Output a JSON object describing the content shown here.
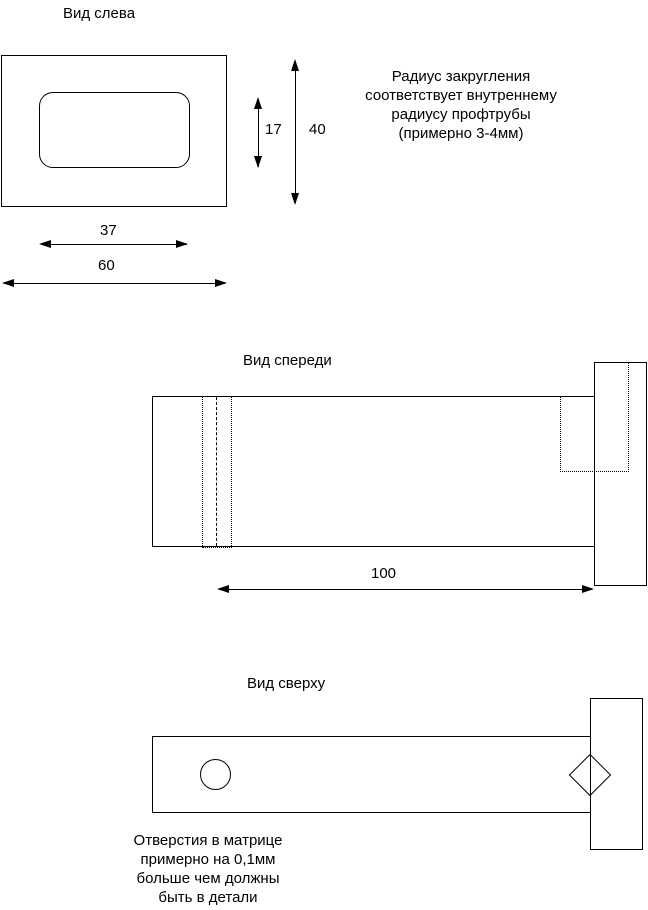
{
  "drawing": {
    "background": "#ffffff",
    "line_color": "#000000",
    "views": {
      "left": {
        "title": "Вид слева",
        "dims": {
          "hole_height": "17",
          "height": "40",
          "hole_width": "37",
          "width": "60"
        }
      },
      "front": {
        "title": "Вид спереди",
        "dims": {
          "length": "100"
        }
      },
      "top": {
        "title": "Вид сверху"
      }
    },
    "notes": {
      "radius_note": {
        "lines": [
          "Радиус закругления",
          "соответствует внутреннему",
          "радиусу профтрубы",
          "(примерно 3-4мм)"
        ]
      },
      "holes_note": {
        "lines": [
          "Отверстия в матрице",
          "примерно на 0,1мм",
          "больше чем должны",
          "быть в детали"
        ]
      }
    }
  }
}
